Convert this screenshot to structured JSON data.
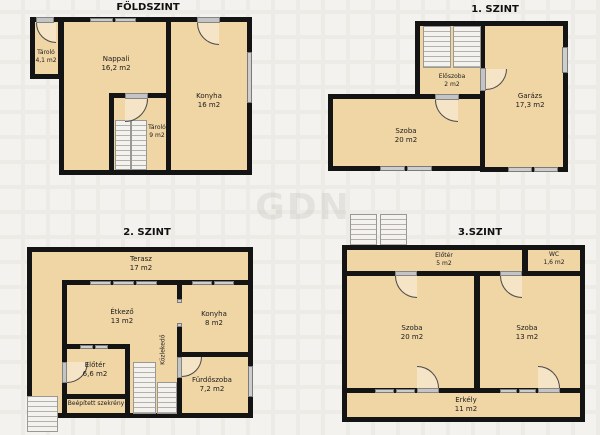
{
  "watermark": {
    "text": "GDN"
  },
  "colors": {
    "wall": "#141414",
    "room_fill": "#f0d5a5",
    "window": "#cdcdcd",
    "background": "#f4f2ef",
    "door_arc": "#4a4a4a"
  },
  "floors": {
    "foldszint": {
      "title": "FÖLDSZINT",
      "rooms": {
        "tarolo_kicsi": {
          "name": "Tároló",
          "area": "4,1 m2"
        },
        "nappali": {
          "name": "Nappali",
          "area": "16,2 m2"
        },
        "konyha": {
          "name": "Konyha",
          "area": "16 m2"
        },
        "tarolo9": {
          "name": "Tároló",
          "area": "9 m2"
        }
      }
    },
    "szint1": {
      "title": "1. SZINT",
      "rooms": {
        "eloszoba": {
          "name": "Előszoba",
          "area": "2 m2"
        },
        "garazs": {
          "name": "Garázs",
          "area": "17,3 m2"
        },
        "szoba": {
          "name": "Szoba",
          "area": "20 m2"
        }
      }
    },
    "szint2": {
      "title": "2. SZINT",
      "rooms": {
        "terasz": {
          "name": "Terasz",
          "area": "17 m2"
        },
        "etkezo": {
          "name": "Étkező",
          "area": "13 m2"
        },
        "konyha": {
          "name": "Konyha",
          "area": "8 m2"
        },
        "kozlekedo": {
          "name": "Közlekedő"
        },
        "eloter": {
          "name": "Előtér",
          "area": "6,6 m2"
        },
        "furdoszoba": {
          "name": "Fürdőszoba",
          "area": "7,2 m2"
        },
        "szekreny": {
          "name": "Beépített szekrény"
        }
      }
    },
    "szint3": {
      "title": "3.SZINT",
      "rooms": {
        "eloter": {
          "name": "Előtér",
          "area": "5 m2"
        },
        "wc": {
          "name": "WC",
          "area": "1,6 m2"
        },
        "szoba20": {
          "name": "Szoba",
          "area": "20 m2"
        },
        "szoba13": {
          "name": "Szoba",
          "area": "13 m2"
        },
        "erkely": {
          "name": "Erkély",
          "area": "11 m2"
        }
      }
    }
  }
}
